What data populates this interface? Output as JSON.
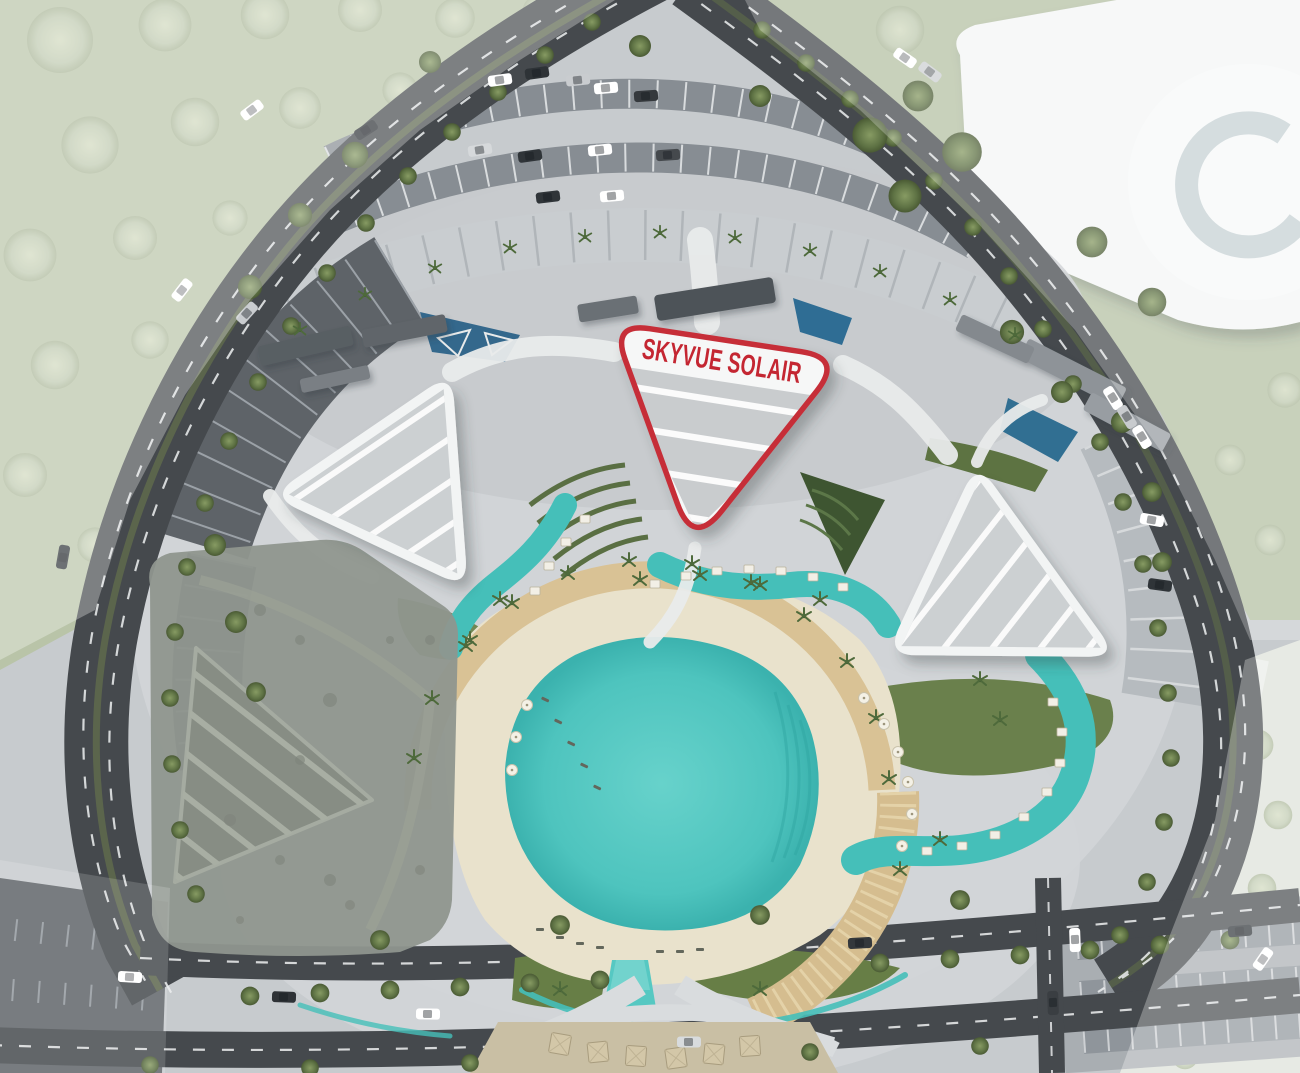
{
  "site_plan": {
    "highlight_label": "SKYVUE SOLAIR",
    "highlighted_parcel": "skyvue-solair-tower",
    "colors": {
      "highlight_red": "#C62D38",
      "label_text_red": "#C42631",
      "lagoon_teal": "#4EC4BE",
      "pool_teal": "#45BFB9",
      "sand_beige": "#E9E2CC",
      "promenade_tan": "#D9C295",
      "road_asphalt": "#45494D",
      "pavement_light": "#CDD1D4",
      "parking_dark": "#5E6368",
      "roof_white": "#F4F5F5",
      "roof_gray": "#CDD0D2",
      "tree_green": "#5E7244",
      "faded_canopy": "#BFCAB0",
      "lawn_green": "#6A804C",
      "future_parcel_gray": "#8F968E",
      "context_building_white": "#F4F6F6"
    },
    "features": {
      "towers": [
        "left-tower",
        "skyvue-solair-tower",
        "right-tower"
      ],
      "amenities": [
        "central-lagoon",
        "beach",
        "promenade",
        "serpentine-pools",
        "cascade-water-feature",
        "cabanas",
        "sun-loungers",
        "entry-plaza"
      ],
      "context": [
        "ring-road",
        "parking-areas",
        "tree-canopy",
        "context-building-c",
        "future-parcel"
      ]
    }
  }
}
